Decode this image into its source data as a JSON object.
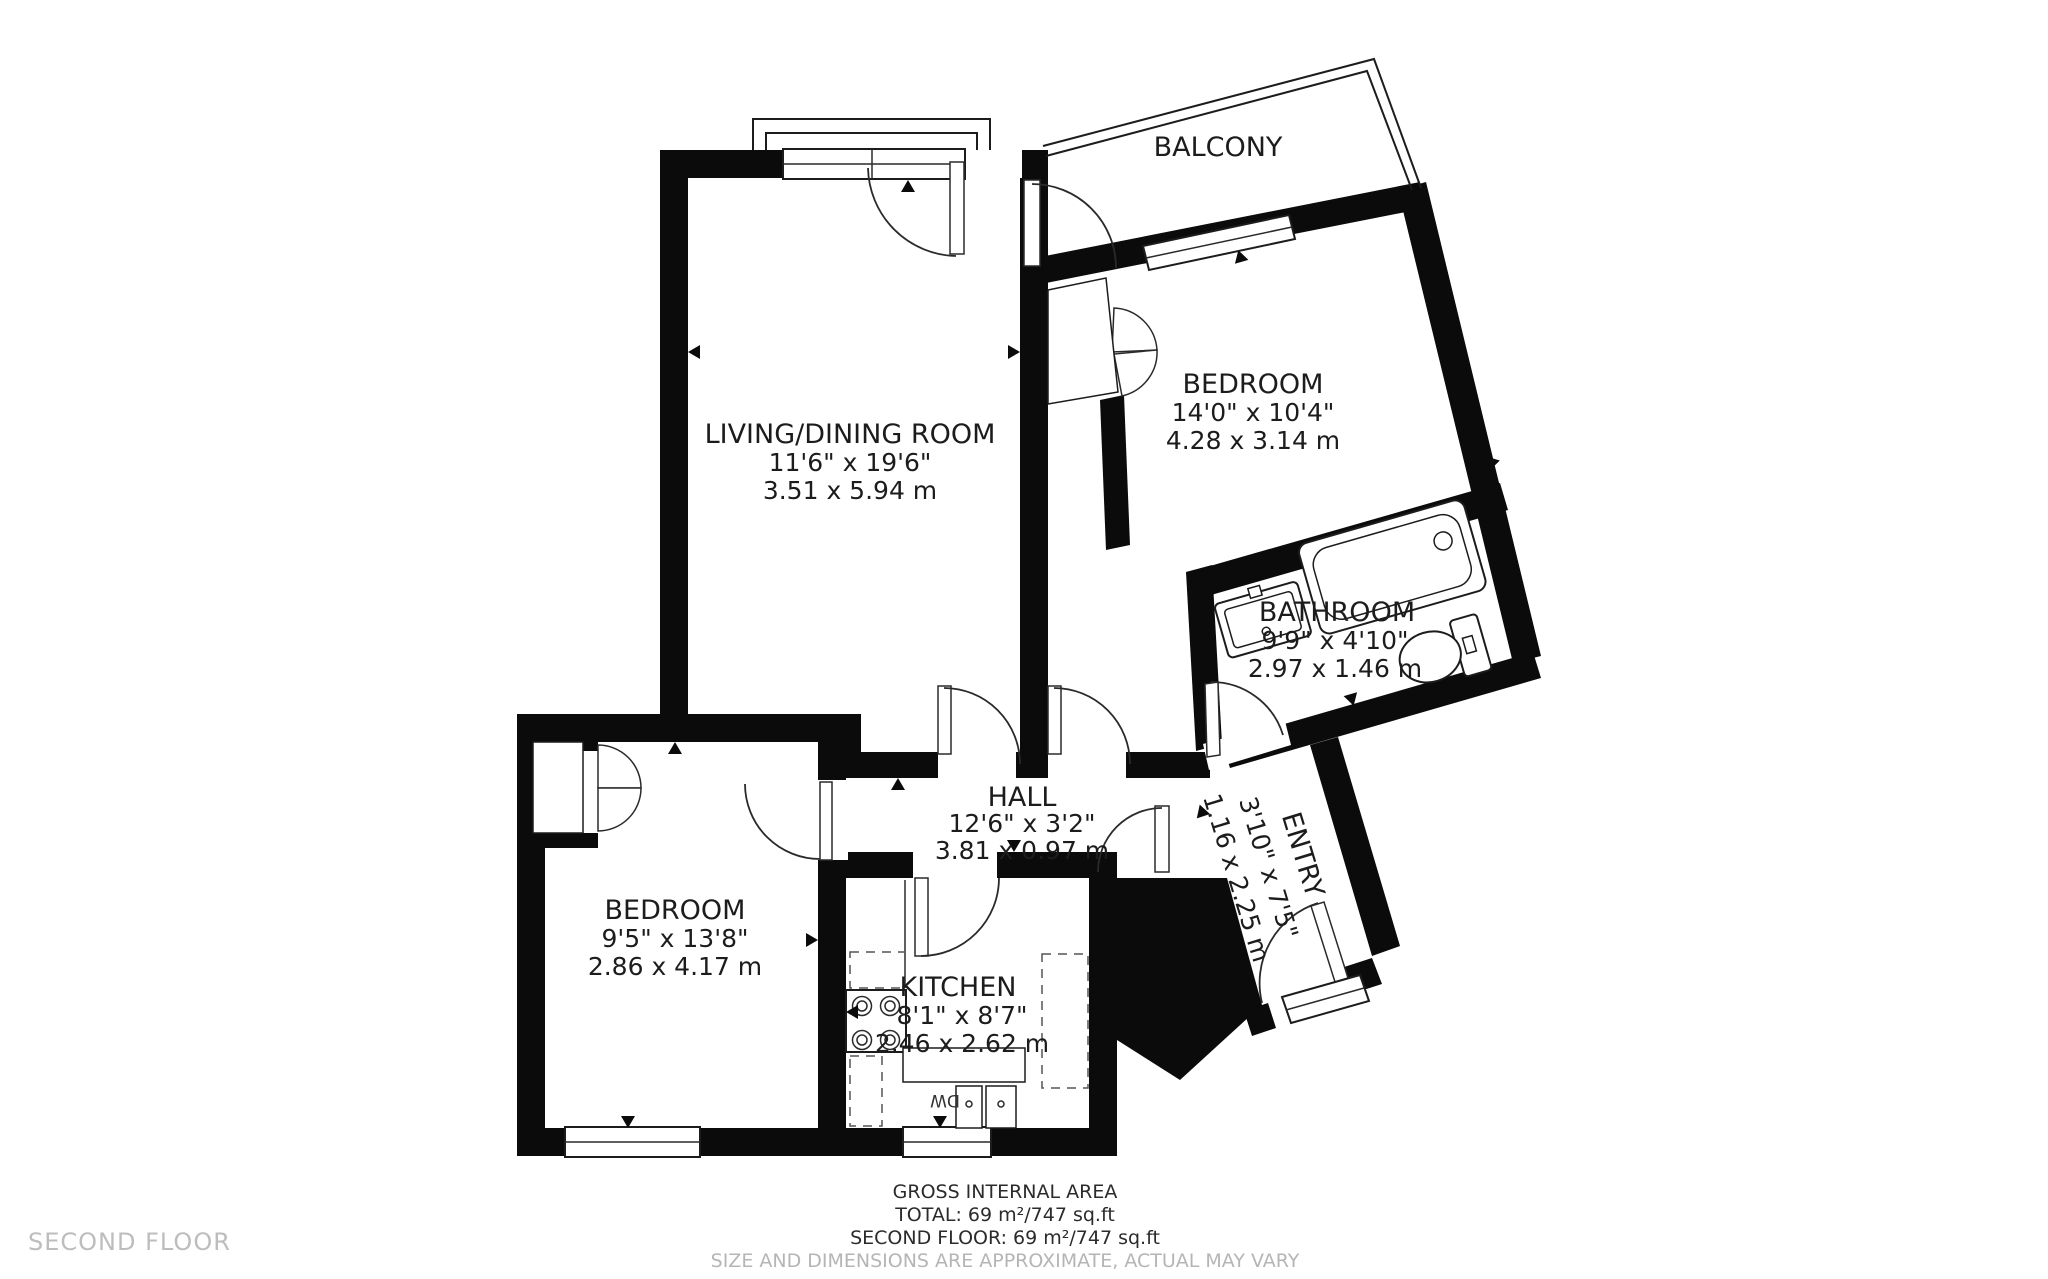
{
  "floor_label": "SECOND FLOOR",
  "rooms": {
    "living": {
      "name": "LIVING/DINING ROOM",
      "imperial": "11'6\" x 19'6\"",
      "metric": "3.51 x 5.94 m"
    },
    "bedroom_right": {
      "name": "BEDROOM",
      "imperial": "14'0\" x 10'4\"",
      "metric": "4.28 x 3.14 m"
    },
    "bathroom": {
      "name": "BATHROOM",
      "imperial": "9'9\" x 4'10\"",
      "metric": "2.97 x 1.46 m"
    },
    "balcony": {
      "name": "BALCONY"
    },
    "hall": {
      "name": "HALL",
      "imperial": "12'6\" x 3'2\"",
      "metric": "3.81 x 0.97 m"
    },
    "entry": {
      "name": "ENTRY",
      "imperial": "3'10\" x 7'5\"",
      "metric": "1.16 x 2.25 m"
    },
    "bedroom_left": {
      "name": "BEDROOM",
      "imperial": "9'5\" x 13'8\"",
      "metric": "2.86 x 4.17 m"
    },
    "kitchen": {
      "name": "KITCHEN",
      "imperial": "8'1\" x 8'7\"",
      "metric": "2.46 x 2.62 m"
    }
  },
  "appliances": {
    "dishwasher": "DW"
  },
  "footer": {
    "line1": "GROSS INTERNAL AREA",
    "line2": "TOTAL: 69 m²/747 sq.ft",
    "line3": "SECOND FLOOR: 69 m²/747 sq.ft",
    "line4": "SIZE AND DIMENSIONS ARE APPROXIMATE, ACTUAL MAY VARY"
  },
  "colors": {
    "wall": "#0b0b0b",
    "text": "#1c1c1c",
    "muted": "#b5b5b5"
  }
}
